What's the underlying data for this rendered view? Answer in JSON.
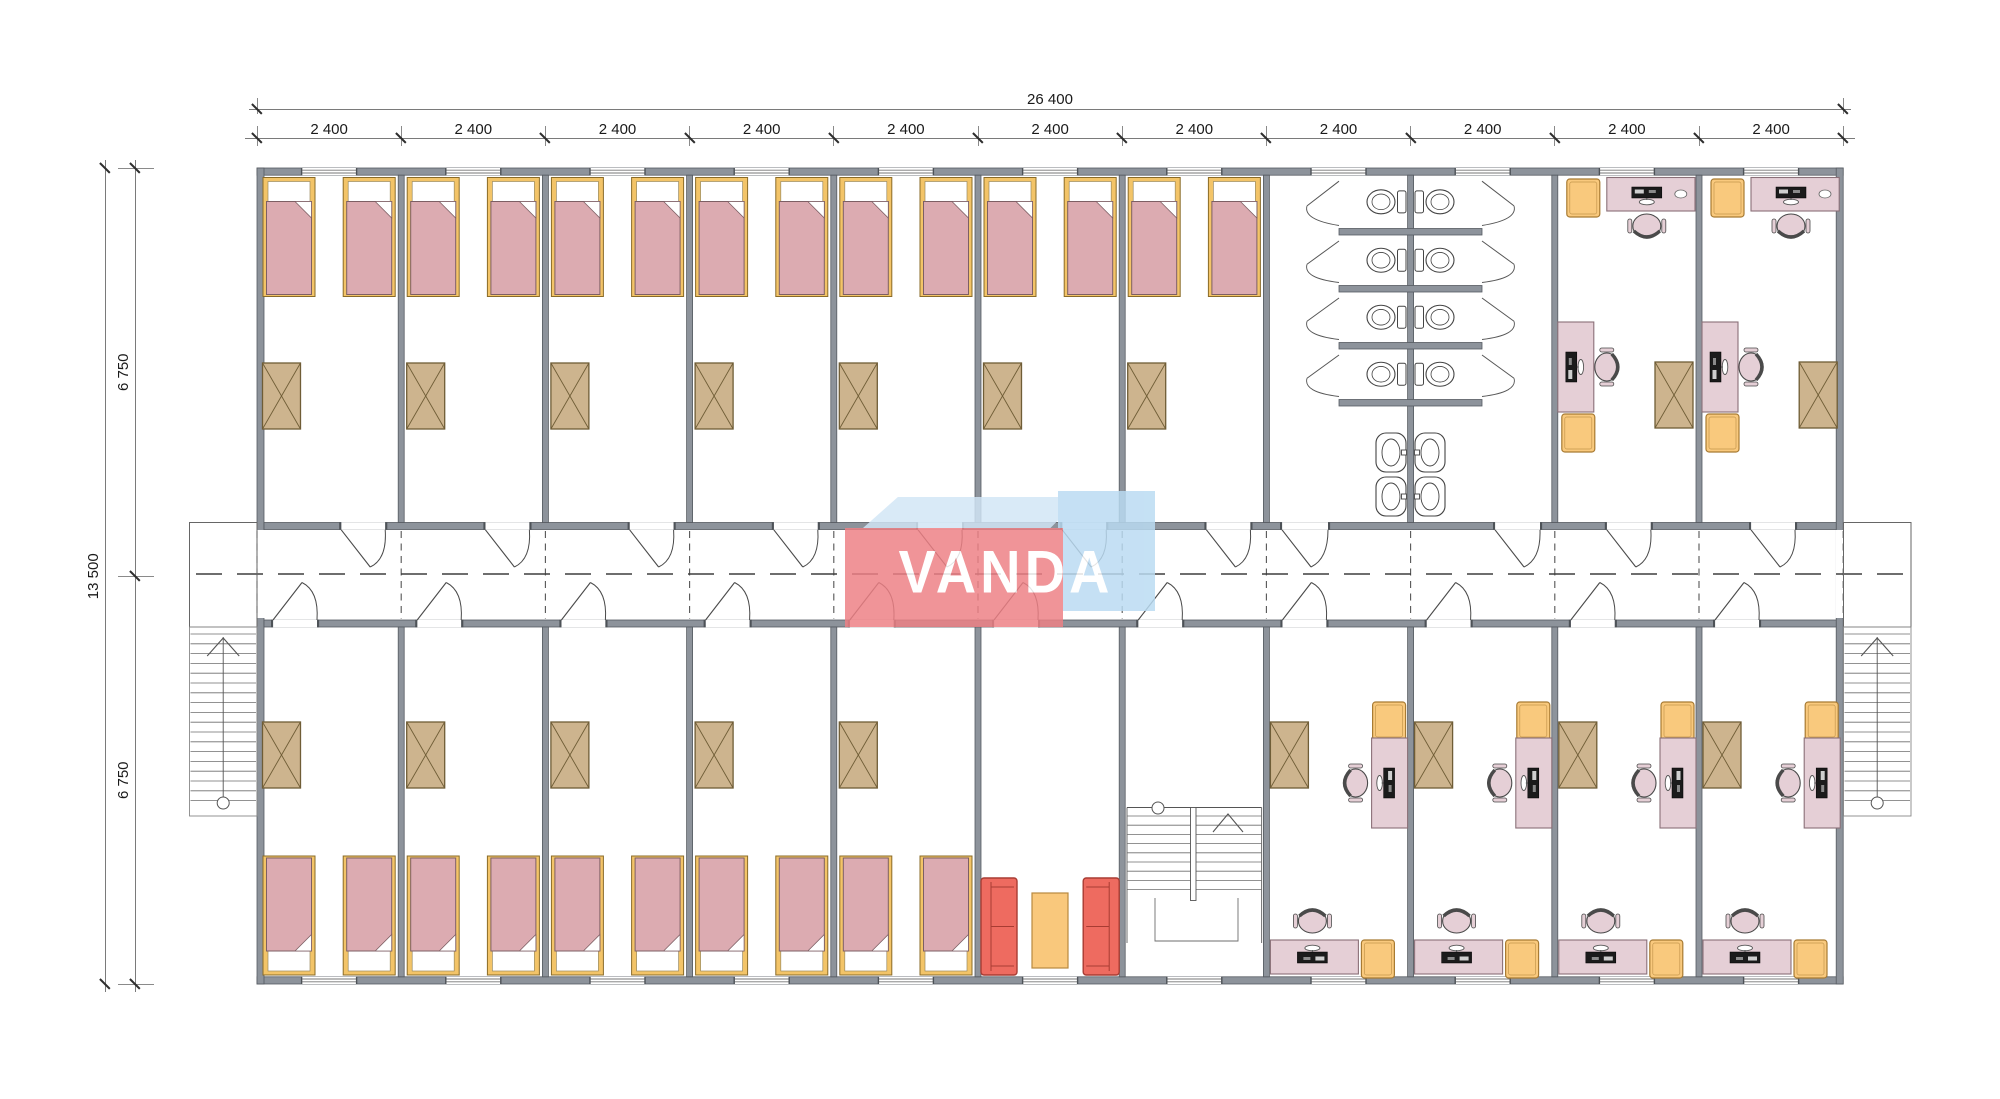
{
  "watermark": {
    "text": "VANDA"
  },
  "dimensions": {
    "total_width": "26 400",
    "bay_width": "2 400",
    "total_height": "13 500",
    "half_height": "6 750"
  },
  "colors": {
    "wall": "#8d939b",
    "wall_edge": "#565b61",
    "jamb": "#4d5257",
    "bed_frame": "#f3c468",
    "bed_frame_edge": "#8a6b28",
    "blanket": "#dcabb1",
    "blanket_edge": "#7d5f64",
    "wardrobe": "#cdb48e",
    "wardrobe_edge": "#6f5d36",
    "desk": "#e5cfd6",
    "desk_edge": "#8a7078",
    "cabinet": "#f9c97d",
    "cabinet_edge": "#a87b33",
    "sofa": "#ee6b60",
    "sofa_edge": "#a83c33",
    "table": "#f9c87c",
    "table_edge": "#b8893f",
    "fixture_line": "#444444",
    "door_line": "#4a4a4a",
    "stair_line": "#6e6e6e",
    "dim_line": "#7a7a7a",
    "dim_text": "#1a1a1a",
    "logo_red": "#ee8085",
    "logo_blue": "#badbf2",
    "logo_blue_light": "#d2e6f6"
  }
}
